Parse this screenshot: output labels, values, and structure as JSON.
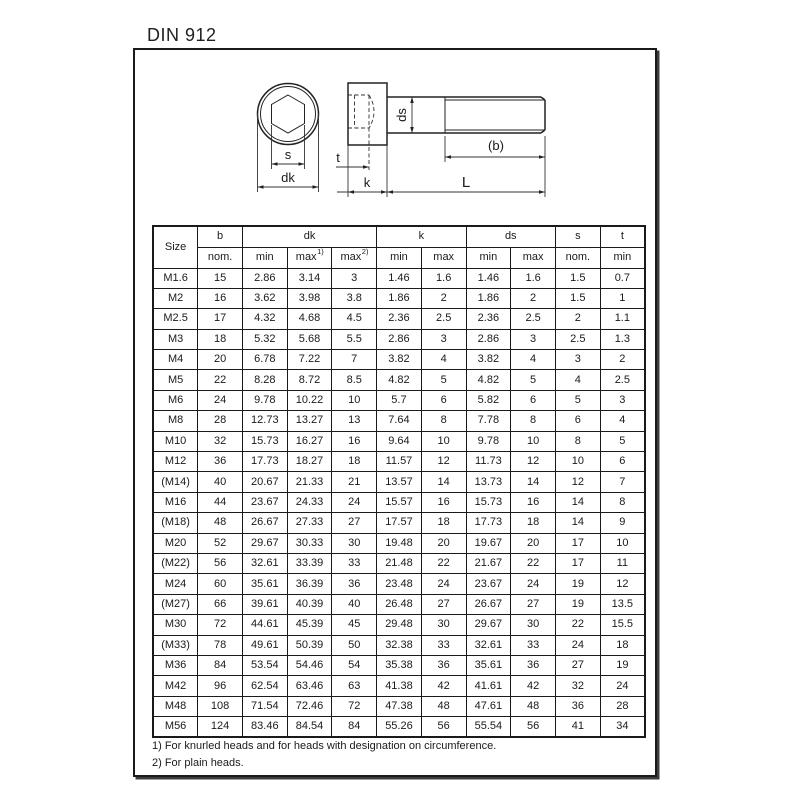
{
  "title": "DIN 912",
  "drawing": {
    "labels": {
      "s": "s",
      "dk": "dk",
      "t": "t",
      "k": "k",
      "L": "L",
      "ds": "ds",
      "b": "(b)"
    }
  },
  "table": {
    "header": {
      "size": "Size",
      "b": {
        "label": "b",
        "sub": "nom."
      },
      "dk": {
        "label": "dk",
        "subs": [
          "min",
          "max",
          "max"
        ],
        "sups": [
          "",
          "1)",
          "2)"
        ]
      },
      "k": {
        "label": "k",
        "subs": [
          "min",
          "max"
        ]
      },
      "ds": {
        "label": "ds",
        "subs": [
          "min",
          "max"
        ]
      },
      "s": {
        "label": "s",
        "sub": "nom."
      },
      "t": {
        "label": "t",
        "sub": "min"
      }
    },
    "rows": [
      [
        "M1.6",
        "15",
        "2.86",
        "3.14",
        "3",
        "1.46",
        "1.6",
        "1.46",
        "1.6",
        "1.5",
        "0.7"
      ],
      [
        "M2",
        "16",
        "3.62",
        "3.98",
        "3.8",
        "1.86",
        "2",
        "1.86",
        "2",
        "1.5",
        "1"
      ],
      [
        "M2.5",
        "17",
        "4.32",
        "4.68",
        "4.5",
        "2.36",
        "2.5",
        "2.36",
        "2.5",
        "2",
        "1.1"
      ],
      [
        "M3",
        "18",
        "5.32",
        "5.68",
        "5.5",
        "2.86",
        "3",
        "2.86",
        "3",
        "2.5",
        "1.3"
      ],
      [
        "M4",
        "20",
        "6.78",
        "7.22",
        "7",
        "3.82",
        "4",
        "3.82",
        "4",
        "3",
        "2"
      ],
      [
        "M5",
        "22",
        "8.28",
        "8.72",
        "8.5",
        "4.82",
        "5",
        "4.82",
        "5",
        "4",
        "2.5"
      ],
      [
        "M6",
        "24",
        "9.78",
        "10.22",
        "10",
        "5.7",
        "6",
        "5.82",
        "6",
        "5",
        "3"
      ],
      [
        "M8",
        "28",
        "12.73",
        "13.27",
        "13",
        "7.64",
        "8",
        "7.78",
        "8",
        "6",
        "4"
      ],
      [
        "M10",
        "32",
        "15.73",
        "16.27",
        "16",
        "9.64",
        "10",
        "9.78",
        "10",
        "8",
        "5"
      ],
      [
        "M12",
        "36",
        "17.73",
        "18.27",
        "18",
        "11.57",
        "12",
        "11.73",
        "12",
        "10",
        "6"
      ],
      [
        "(M14)",
        "40",
        "20.67",
        "21.33",
        "21",
        "13.57",
        "14",
        "13.73",
        "14",
        "12",
        "7"
      ],
      [
        "M16",
        "44",
        "23.67",
        "24.33",
        "24",
        "15.57",
        "16",
        "15.73",
        "16",
        "14",
        "8"
      ],
      [
        "(M18)",
        "48",
        "26.67",
        "27.33",
        "27",
        "17.57",
        "18",
        "17.73",
        "18",
        "14",
        "9"
      ],
      [
        "M20",
        "52",
        "29.67",
        "30.33",
        "30",
        "19.48",
        "20",
        "19.67",
        "20",
        "17",
        "10"
      ],
      [
        "(M22)",
        "56",
        "32.61",
        "33.39",
        "33",
        "21.48",
        "22",
        "21.67",
        "22",
        "17",
        "11"
      ],
      [
        "M24",
        "60",
        "35.61",
        "36.39",
        "36",
        "23.48",
        "24",
        "23.67",
        "24",
        "19",
        "12"
      ],
      [
        "(M27)",
        "66",
        "39.61",
        "40.39",
        "40",
        "26.48",
        "27",
        "26.67",
        "27",
        "19",
        "13.5"
      ],
      [
        "M30",
        "72",
        "44.61",
        "45.39",
        "45",
        "29.48",
        "30",
        "29.67",
        "30",
        "22",
        "15.5"
      ],
      [
        "(M33)",
        "78",
        "49.61",
        "50.39",
        "50",
        "32.38",
        "33",
        "32.61",
        "33",
        "24",
        "18"
      ],
      [
        "M36",
        "84",
        "53.54",
        "54.46",
        "54",
        "35.38",
        "36",
        "35.61",
        "36",
        "27",
        "19"
      ],
      [
        "M42",
        "96",
        "62.54",
        "63.46",
        "63",
        "41.38",
        "42",
        "41.61",
        "42",
        "32",
        "24"
      ],
      [
        "M48",
        "108",
        "71.54",
        "72.46",
        "72",
        "47.38",
        "48",
        "47.61",
        "48",
        "36",
        "28"
      ],
      [
        "M56",
        "124",
        "83.46",
        "84.54",
        "84",
        "55.26",
        "56",
        "55.54",
        "56",
        "41",
        "34"
      ]
    ]
  },
  "footnotes": [
    "1) For knurled heads and for heads with designation on circumference.",
    "2) For plain heads."
  ]
}
